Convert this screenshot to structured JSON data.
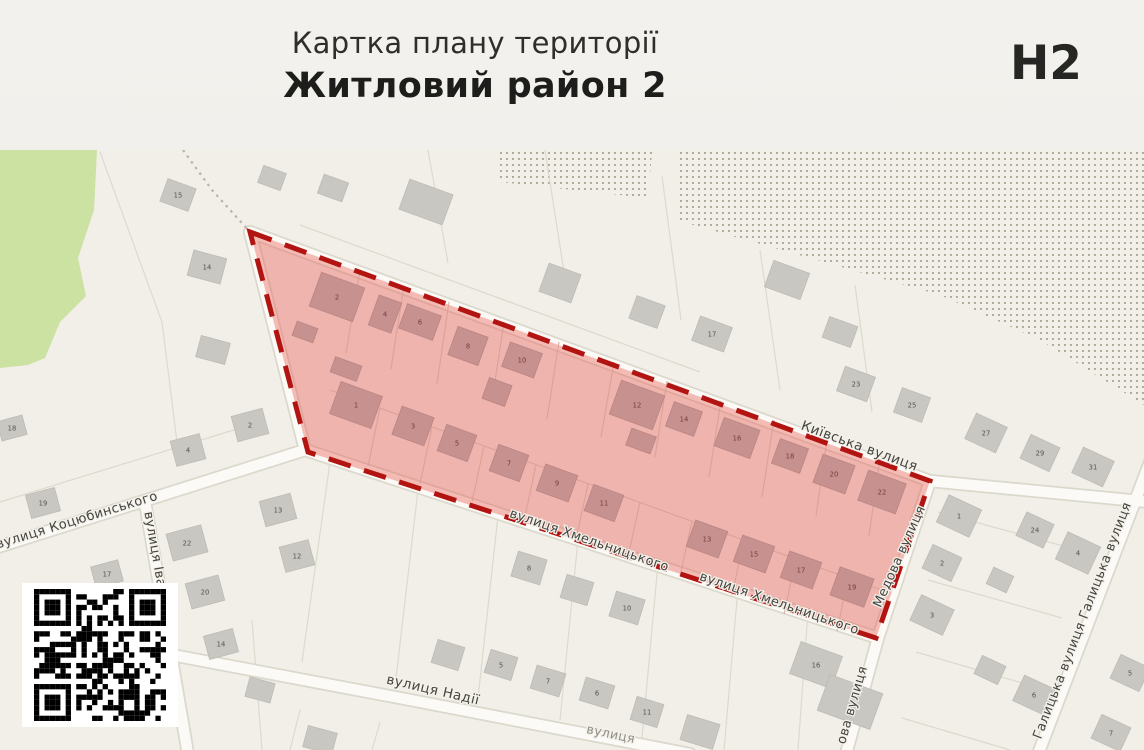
{
  "header": {
    "subtitle": "Картка плану території",
    "title": "Житловий район 2",
    "code": "Н2"
  },
  "map": {
    "colors": {
      "map_bg": "#f1efe8",
      "zone_fill": "#e9544d",
      "zone_fill_opacity": "0.38",
      "zone_border": "#b21511",
      "green_area": "#cbe2a2",
      "dots": "#a8a795",
      "street_fill": "#fbfaf6",
      "street_casing": "#dbd8cc",
      "parcel_line": "#dcd8cb",
      "inner_parcel_line": "#d89d94",
      "building_out": "#c9c7c2",
      "building_in": "#c79190",
      "label_color": "#45443f",
      "label_halo": "#f3f1ea",
      "number_out": "#55534e",
      "number_in": "#70403d",
      "qr_dark": "#000000",
      "qr_light": "#ffffff"
    },
    "street_labels": [
      {
        "t": "Київська вулиця",
        "x": 858,
        "y": 300,
        "r": 20,
        "s": 13.5
      },
      {
        "t": "вулиця Хмельницького",
        "x": 588,
        "y": 394,
        "r": 19,
        "s": 13
      },
      {
        "t": "вулиця Хмельницького",
        "x": 778,
        "y": 457,
        "r": 19,
        "s": 13
      },
      {
        "t": "Медова вулиця",
        "x": 903,
        "y": 408,
        "r": -66,
        "s": 13
      },
      {
        "t": "ова вулиця",
        "x": 856,
        "y": 556,
        "r": -74,
        "s": 13
      },
      {
        "t": "вулиця Коцюбинського",
        "x": 78,
        "y": 374,
        "r": -17,
        "s": 13
      },
      {
        "t": "вулиця Іва",
        "x": 151,
        "y": 400,
        "r": 80,
        "s": 13
      },
      {
        "t": "вулиця Надії",
        "x": 432,
        "y": 544,
        "r": 13,
        "s": 13.5
      },
      {
        "t": "вулиця",
        "x": 610,
        "y": 588,
        "r": 12,
        "s": 12.5,
        "f": true
      },
      {
        "t": "Галицька вулиця Галицька вулиця",
        "x": 1086,
        "y": 472,
        "r": -69,
        "s": 13
      }
    ],
    "buildings": [
      {
        "n": "2",
        "x": 337,
        "y": 147,
        "w": 46,
        "h": 36,
        "r": 20,
        "z": "in"
      },
      {
        "n": "",
        "x": 305,
        "y": 182,
        "w": 22,
        "h": 15,
        "r": 20,
        "z": "in"
      },
      {
        "n": "4",
        "x": 385,
        "y": 164,
        "w": 24,
        "h": 32,
        "r": 20,
        "z": "in"
      },
      {
        "n": "6",
        "x": 420,
        "y": 172,
        "w": 36,
        "h": 26,
        "r": 20,
        "z": "in"
      },
      {
        "n": "8",
        "x": 468,
        "y": 196,
        "w": 32,
        "h": 30,
        "r": 20,
        "z": "in"
      },
      {
        "n": "10",
        "x": 522,
        "y": 210,
        "w": 34,
        "h": 26,
        "r": 20,
        "z": "in"
      },
      {
        "n": "12",
        "x": 637,
        "y": 255,
        "w": 46,
        "h": 36,
        "r": 20,
        "z": "in"
      },
      {
        "n": "14",
        "x": 684,
        "y": 269,
        "w": 30,
        "h": 26,
        "r": 20,
        "z": "in"
      },
      {
        "n": "16",
        "x": 737,
        "y": 288,
        "w": 38,
        "h": 30,
        "r": 20,
        "z": "in"
      },
      {
        "n": "18",
        "x": 790,
        "y": 306,
        "w": 30,
        "h": 26,
        "r": 20,
        "z": "in"
      },
      {
        "n": "20",
        "x": 834,
        "y": 324,
        "w": 34,
        "h": 30,
        "r": 20,
        "z": "in"
      },
      {
        "n": "22",
        "x": 882,
        "y": 342,
        "w": 40,
        "h": 32,
        "r": 20,
        "z": "in"
      },
      {
        "n": "1",
        "x": 356,
        "y": 255,
        "w": 44,
        "h": 34,
        "r": 20,
        "z": "in"
      },
      {
        "n": "3",
        "x": 413,
        "y": 276,
        "w": 34,
        "h": 30,
        "r": 20,
        "z": "in"
      },
      {
        "n": "5",
        "x": 457,
        "y": 293,
        "w": 32,
        "h": 28,
        "r": 20,
        "z": "in"
      },
      {
        "n": "7",
        "x": 509,
        "y": 313,
        "w": 32,
        "h": 28,
        "r": 20,
        "z": "in"
      },
      {
        "n": "9",
        "x": 557,
        "y": 333,
        "w": 34,
        "h": 28,
        "r": 20,
        "z": "in"
      },
      {
        "n": "11",
        "x": 604,
        "y": 353,
        "w": 32,
        "h": 28,
        "r": 20,
        "z": "in"
      },
      {
        "n": "13",
        "x": 707,
        "y": 389,
        "w": 34,
        "h": 28,
        "r": 20,
        "z": "in"
      },
      {
        "n": "15",
        "x": 754,
        "y": 404,
        "w": 34,
        "h": 28,
        "r": 20,
        "z": "in"
      },
      {
        "n": "17",
        "x": 801,
        "y": 420,
        "w": 34,
        "h": 28,
        "r": 20,
        "z": "in"
      },
      {
        "n": "19",
        "x": 852,
        "y": 437,
        "w": 36,
        "h": 30,
        "r": 20,
        "z": "in"
      },
      {
        "n": "",
        "x": 346,
        "y": 219,
        "w": 28,
        "h": 16,
        "r": 20,
        "z": "in"
      },
      {
        "n": "",
        "x": 497,
        "y": 242,
        "w": 24,
        "h": 22,
        "r": 20,
        "z": "in"
      },
      {
        "n": "",
        "x": 641,
        "y": 291,
        "w": 26,
        "h": 18,
        "r": 20,
        "z": "in"
      },
      {
        "n": "15",
        "x": 178,
        "y": 45,
        "w": 30,
        "h": 24,
        "r": 20,
        "z": "out"
      },
      {
        "n": "14",
        "x": 207,
        "y": 117,
        "w": 34,
        "h": 26,
        "r": 15,
        "z": "out"
      },
      {
        "n": "",
        "x": 213,
        "y": 200,
        "w": 30,
        "h": 22,
        "r": 15,
        "z": "out"
      },
      {
        "n": "",
        "x": 272,
        "y": 28,
        "w": 24,
        "h": 18,
        "r": 20,
        "z": "out"
      },
      {
        "n": "",
        "x": 333,
        "y": 38,
        "w": 26,
        "h": 20,
        "r": 20,
        "z": "out"
      },
      {
        "n": "",
        "x": 426,
        "y": 52,
        "w": 46,
        "h": 32,
        "r": 20,
        "z": "out"
      },
      {
        "n": "",
        "x": 560,
        "y": 133,
        "w": 34,
        "h": 30,
        "r": 20,
        "z": "out"
      },
      {
        "n": "",
        "x": 647,
        "y": 162,
        "w": 30,
        "h": 24,
        "r": 20,
        "z": "out"
      },
      {
        "n": "17",
        "x": 712,
        "y": 184,
        "w": 34,
        "h": 26,
        "r": 20,
        "z": "out"
      },
      {
        "n": "",
        "x": 787,
        "y": 130,
        "w": 38,
        "h": 28,
        "r": 20,
        "z": "out"
      },
      {
        "n": "",
        "x": 840,
        "y": 182,
        "w": 30,
        "h": 22,
        "r": 20,
        "z": "out"
      },
      {
        "n": "23",
        "x": 856,
        "y": 234,
        "w": 32,
        "h": 26,
        "r": 20,
        "z": "out"
      },
      {
        "n": "25",
        "x": 912,
        "y": 255,
        "w": 30,
        "h": 26,
        "r": 20,
        "z": "out"
      },
      {
        "n": "18",
        "x": 12,
        "y": 278,
        "w": 26,
        "h": 20,
        "r": -15,
        "z": "out"
      },
      {
        "n": "19",
        "x": 43,
        "y": 353,
        "w": 30,
        "h": 24,
        "r": -15,
        "z": "out"
      },
      {
        "n": "2",
        "x": 250,
        "y": 275,
        "w": 32,
        "h": 26,
        "r": -15,
        "z": "out"
      },
      {
        "n": "4",
        "x": 188,
        "y": 300,
        "w": 30,
        "h": 26,
        "r": -15,
        "z": "out"
      },
      {
        "n": "22",
        "x": 187,
        "y": 393,
        "w": 36,
        "h": 28,
        "r": -15,
        "z": "out"
      },
      {
        "n": "13",
        "x": 278,
        "y": 360,
        "w": 32,
        "h": 26,
        "r": -15,
        "z": "out"
      },
      {
        "n": "12",
        "x": 297,
        "y": 406,
        "w": 30,
        "h": 26,
        "r": -15,
        "z": "out"
      },
      {
        "n": "20",
        "x": 205,
        "y": 442,
        "w": 34,
        "h": 26,
        "r": -15,
        "z": "out"
      },
      {
        "n": "14",
        "x": 221,
        "y": 494,
        "w": 30,
        "h": 24,
        "r": -15,
        "z": "out"
      },
      {
        "n": "17",
        "x": 107,
        "y": 424,
        "w": 28,
        "h": 22,
        "r": -15,
        "z": "out"
      },
      {
        "n": "8",
        "x": 529,
        "y": 418,
        "w": 30,
        "h": 26,
        "r": 17,
        "z": "out"
      },
      {
        "n": "",
        "x": 577,
        "y": 440,
        "w": 28,
        "h": 24,
        "r": 17,
        "z": "out"
      },
      {
        "n": "10",
        "x": 627,
        "y": 458,
        "w": 30,
        "h": 26,
        "r": 17,
        "z": "out"
      },
      {
        "n": "",
        "x": 448,
        "y": 505,
        "w": 28,
        "h": 24,
        "r": 17,
        "z": "out"
      },
      {
        "n": "5",
        "x": 501,
        "y": 515,
        "w": 28,
        "h": 24,
        "r": 17,
        "z": "out"
      },
      {
        "n": "7",
        "x": 548,
        "y": 531,
        "w": 30,
        "h": 24,
        "r": 17,
        "z": "out"
      },
      {
        "n": "6",
        "x": 597,
        "y": 543,
        "w": 30,
        "h": 24,
        "r": 17,
        "z": "out"
      },
      {
        "n": "11",
        "x": 647,
        "y": 562,
        "w": 28,
        "h": 24,
        "r": 17,
        "z": "out"
      },
      {
        "n": "16",
        "x": 816,
        "y": 515,
        "w": 44,
        "h": 34,
        "r": 20,
        "z": "out"
      },
      {
        "n": "",
        "x": 850,
        "y": 552,
        "w": 56,
        "h": 38,
        "r": 20,
        "z": "out"
      },
      {
        "n": "",
        "x": 700,
        "y": 582,
        "w": 34,
        "h": 26,
        "r": 17,
        "z": "out"
      },
      {
        "n": "",
        "x": 320,
        "y": 590,
        "w": 30,
        "h": 22,
        "r": 15,
        "z": "out"
      },
      {
        "n": "",
        "x": 260,
        "y": 540,
        "w": 26,
        "h": 20,
        "r": 15,
        "z": "out"
      },
      {
        "n": "27",
        "x": 986,
        "y": 283,
        "w": 34,
        "h": 28,
        "r": 25,
        "z": "out"
      },
      {
        "n": "29",
        "x": 1040,
        "y": 303,
        "w": 32,
        "h": 26,
        "r": 25,
        "z": "out"
      },
      {
        "n": "31",
        "x": 1093,
        "y": 317,
        "w": 34,
        "h": 28,
        "r": 25,
        "z": "out"
      },
      {
        "n": "1",
        "x": 959,
        "y": 366,
        "w": 36,
        "h": 30,
        "r": 25,
        "z": "out"
      },
      {
        "n": "24",
        "x": 1035,
        "y": 380,
        "w": 30,
        "h": 26,
        "r": 25,
        "z": "out"
      },
      {
        "n": "4",
        "x": 1078,
        "y": 403,
        "w": 36,
        "h": 30,
        "r": 25,
        "z": "out"
      },
      {
        "n": "2",
        "x": 942,
        "y": 413,
        "w": 32,
        "h": 26,
        "r": 25,
        "z": "out"
      },
      {
        "n": "",
        "x": 1000,
        "y": 430,
        "w": 22,
        "h": 18,
        "r": 25,
        "z": "out"
      },
      {
        "n": "3",
        "x": 932,
        "y": 465,
        "w": 36,
        "h": 28,
        "r": 25,
        "z": "out"
      },
      {
        "n": "",
        "x": 990,
        "y": 520,
        "w": 26,
        "h": 20,
        "r": 25,
        "z": "out"
      },
      {
        "n": "5",
        "x": 1130,
        "y": 523,
        "w": 32,
        "h": 26,
        "r": 25,
        "z": "out"
      },
      {
        "n": "6",
        "x": 1034,
        "y": 545,
        "w": 34,
        "h": 28,
        "r": 25,
        "z": "out"
      },
      {
        "n": "7",
        "x": 1111,
        "y": 583,
        "w": 32,
        "h": 26,
        "r": 25,
        "z": "out"
      }
    ]
  },
  "icons": {
    "qr": "qr-code"
  }
}
